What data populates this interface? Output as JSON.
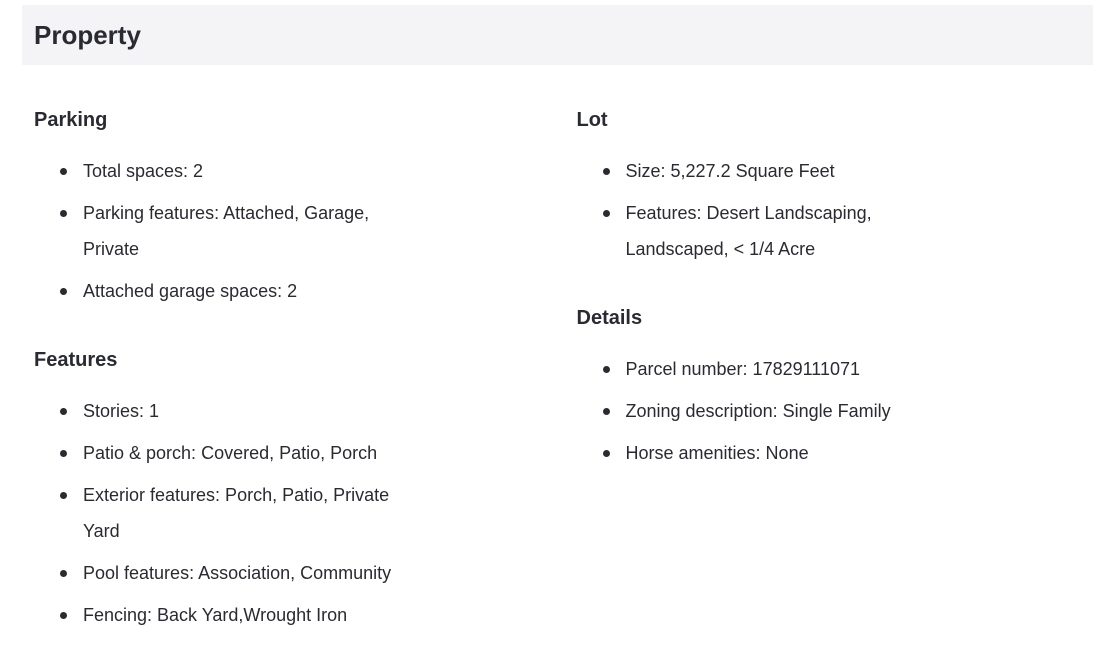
{
  "header": {
    "title": "Property"
  },
  "columns": {
    "left": {
      "parking": {
        "heading": "Parking",
        "items": [
          "Total spaces: 2",
          "Parking features: Attached, Garage, Private",
          "Attached garage spaces: 2"
        ]
      },
      "features": {
        "heading": "Features",
        "items": [
          "Stories: 1",
          "Patio & porch: Covered, Patio, Porch",
          "Exterior features: Porch, Patio, Private Yard",
          "Pool features: Association, Community",
          "Fencing: Back Yard,Wrought Iron"
        ]
      }
    },
    "right": {
      "lot": {
        "heading": "Lot",
        "items": [
          "Size: 5,227.2 Square Feet",
          "Features: Desert Landscaping, Landscaped, < 1/4 Acre"
        ]
      },
      "details": {
        "heading": "Details",
        "items": [
          "Parcel number: 17829111071",
          "Zoning description: Single Family",
          "Horse amenities: None"
        ]
      }
    }
  },
  "colors": {
    "header_bg": "#f4f4f7",
    "text": "#2a2a33"
  }
}
